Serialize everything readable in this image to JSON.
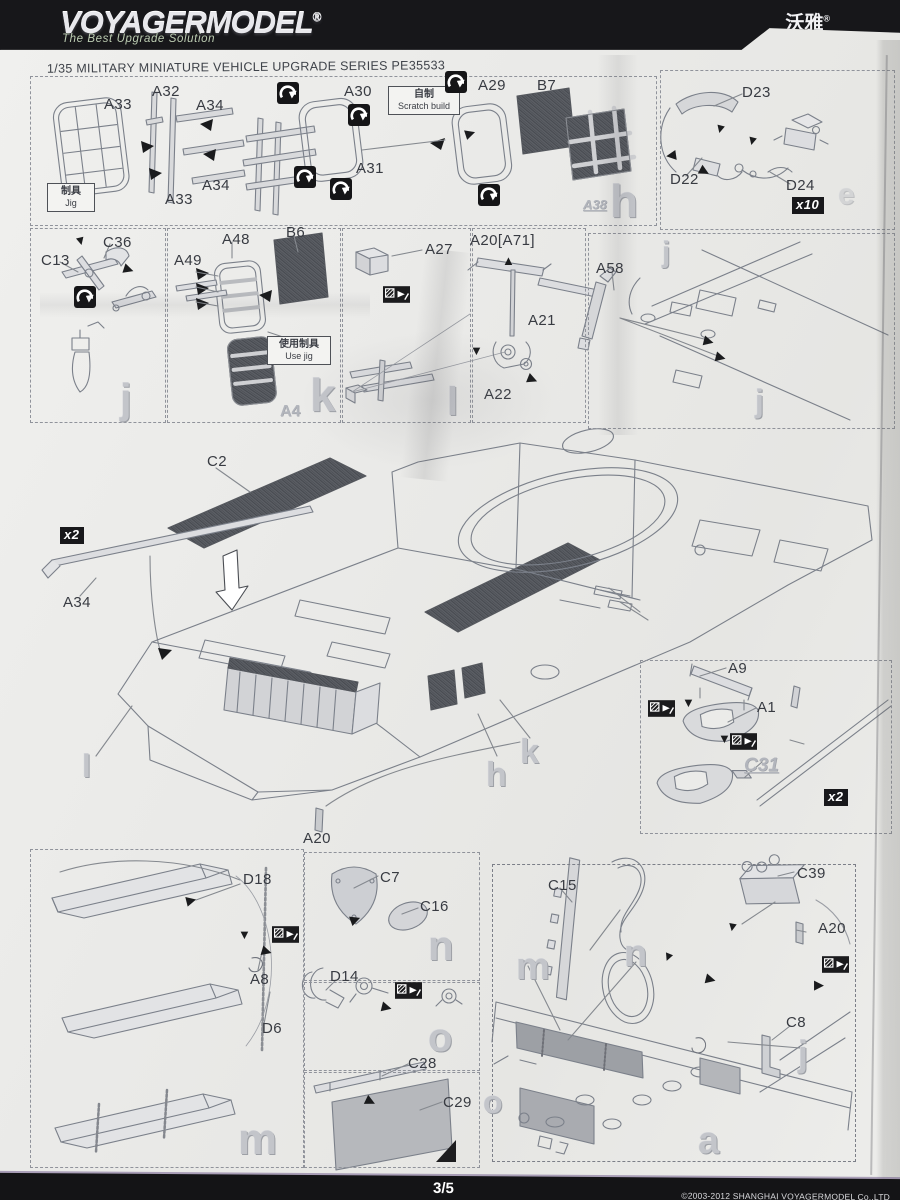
{
  "header": {
    "brand": "VOYAGERMODEL",
    "reg": "®",
    "tagline": "The Best Upgrade Solution",
    "brand_cn": "沃雅",
    "cn_reg": "®",
    "series_title": "1/35 MILITARY MINIATURE VEHICLE  UPGRADE SERIES PE35533"
  },
  "footer": {
    "page": "3/5",
    "copyright": "©2003-2012 SHANGHAI VOYAGERMODEL  Co.,LTD"
  },
  "notes": {
    "jig_zh": "制具",
    "jig_en": "Jig",
    "scratch_zh": "自制",
    "scratch_en": "Scratch build",
    "usejig_zh": "使用制具",
    "usejig_en": "Use jig"
  },
  "badges": {
    "x10": "x10",
    "x2_rail": "x2",
    "x2_shovel": "x2"
  },
  "labels": {
    "a33_1": "A33",
    "a32": "A32",
    "a34_1": "A34",
    "a34_2": "A34",
    "a33_2": "A33",
    "a30": "A30",
    "a31": "A31",
    "a29": "A29",
    "b7": "B7",
    "a38": "A38",
    "d23": "D23",
    "d22": "D22",
    "d24": "D24",
    "c36": "C36",
    "c13": "C13",
    "a48": "A48",
    "b6": "B6",
    "a49": "A49",
    "a4": "A4",
    "a27": "A27",
    "a20a71": "A20[A71]",
    "a21": "A21",
    "a22": "A22",
    "a58": "A58",
    "c2": "C2",
    "a34_rail": "A34",
    "a20_hull": "A20",
    "a9": "A9",
    "a1": "A1",
    "c31": "C31",
    "d18": "D18",
    "a8": "A8",
    "d6": "D6",
    "c7": "C7",
    "c16": "C16",
    "d14": "D14",
    "c28": "C28",
    "c29": "C29",
    "c15": "C15",
    "c39": "C39",
    "a20_side": "A20",
    "c8": "C8"
  },
  "fret_letters": {
    "r1_h": "h",
    "r1_e": "e",
    "r2_j": "j",
    "r2_k": "k",
    "r2_l": "l",
    "r2b5_j1": "j",
    "r2b5_j2": "j",
    "c_l": "l",
    "c_h": "h",
    "c_k": "k",
    "m_m": "m",
    "n_n": "n",
    "o_o": "o",
    "s_m": "m",
    "s_n": "n",
    "s_o": "o",
    "s_j": "j",
    "s_a": "a"
  },
  "icons": {
    "tri_right": "▶",
    "tri_down": "▼",
    "tri_up": "▲",
    "tri_left": "◀"
  }
}
